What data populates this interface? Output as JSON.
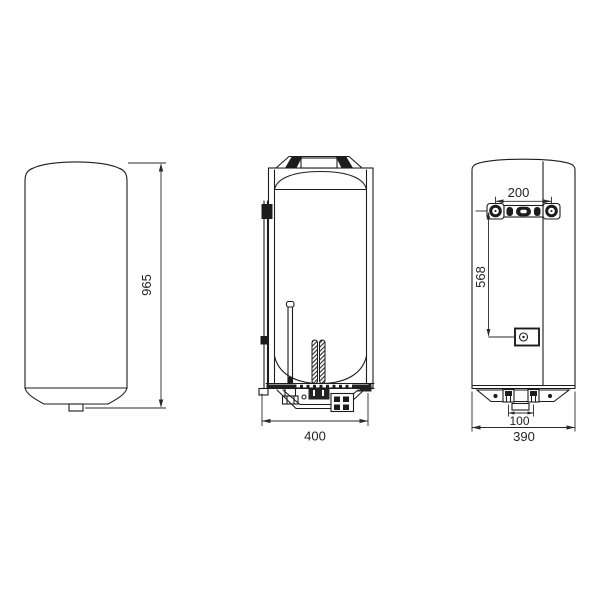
{
  "colors": {
    "background": "#ffffff",
    "line": "#1c1c1c",
    "dimension_text": "#222222"
  },
  "dimensions": {
    "overall_height_mm": "965",
    "front_width_mm": "400",
    "depth_mm": "390",
    "bracket_hole_spacing_mm": "200",
    "bracket_to_lower_anchor_mm": "568",
    "pipe_spacing_mm": "100"
  }
}
